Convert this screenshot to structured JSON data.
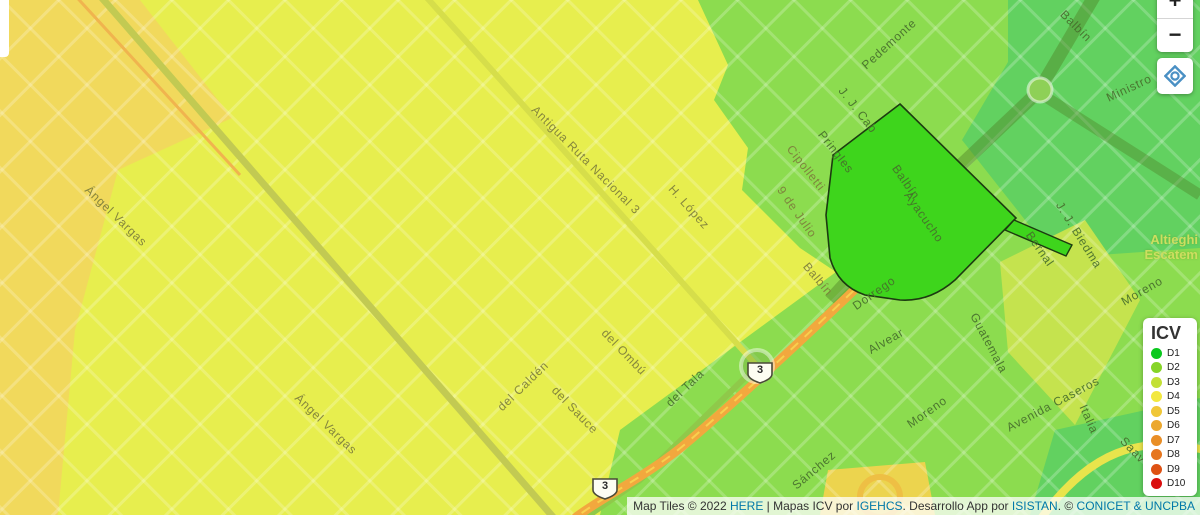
{
  "map": {
    "street_labels": [
      {
        "text": "Ángel Vargas",
        "x": 116,
        "y": 216,
        "rot": 44,
        "zone": "y"
      },
      {
        "text": "Ángel Vargas",
        "x": 326,
        "y": 424,
        "rot": 44,
        "zone": "y"
      },
      {
        "text": "Antigua Ruta Nacional 3",
        "x": 586,
        "y": 160,
        "rot": 45,
        "zone": "y"
      },
      {
        "text": "H. López",
        "x": 689,
        "y": 207,
        "rot": 48,
        "zone": "y"
      },
      {
        "text": "9  de  Julio",
        "x": 797,
        "y": 212,
        "rot": 55,
        "zone": "y"
      },
      {
        "text": "del Caldén",
        "x": 523,
        "y": 386,
        "rot": -44,
        "zone": "y"
      },
      {
        "text": "del Ombú",
        "x": 624,
        "y": 352,
        "rot": 46,
        "zone": "y"
      },
      {
        "text": "del Sauce",
        "x": 575,
        "y": 410,
        "rot": 46,
        "zone": "y"
      },
      {
        "text": "del Tala",
        "x": 685,
        "y": 388,
        "rot": -44,
        "zone": "g"
      },
      {
        "text": "Pedemonte",
        "x": 889,
        "y": 44,
        "rot": -42,
        "zone": "g"
      },
      {
        "text": "J. J. Cab",
        "x": 858,
        "y": 110,
        "rot": 52,
        "zone": "g"
      },
      {
        "text": "Pringles",
        "x": 836,
        "y": 152,
        "rot": 52,
        "zone": "g"
      },
      {
        "text": "Cipolletti",
        "x": 806,
        "y": 168,
        "rot": 52,
        "zone": "y"
      },
      {
        "text": "Balbín",
        "x": 818,
        "y": 279,
        "rot": 50,
        "zone": "y"
      },
      {
        "text": "Balbín",
        "x": 906,
        "y": 182,
        "rot": 55,
        "zone": "g"
      },
      {
        "text": "Ayacucho",
        "x": 924,
        "y": 217,
        "rot": 55,
        "zone": "g"
      },
      {
        "text": "Dorrego",
        "x": 874,
        "y": 293,
        "rot": -35,
        "zone": "g"
      },
      {
        "text": "Alvear",
        "x": 886,
        "y": 341,
        "rot": -30,
        "zone": "g"
      },
      {
        "text": "Moreno",
        "x": 927,
        "y": 412,
        "rot": -35,
        "zone": "g"
      },
      {
        "text": "Guatemala",
        "x": 989,
        "y": 343,
        "rot": 62,
        "zone": "g"
      },
      {
        "text": "Avenida  Caseros",
        "x": 1053,
        "y": 404,
        "rot": -28,
        "zone": "g"
      },
      {
        "text": "Italia",
        "x": 1089,
        "y": 419,
        "rot": 66,
        "zone": "g"
      },
      {
        "text": "Moreno",
        "x": 1142,
        "y": 291,
        "rot": -30,
        "zone": "g"
      },
      {
        "text": "Saav",
        "x": 1133,
        "y": 450,
        "rot": 46,
        "zone": "g"
      },
      {
        "text": "Sánchez",
        "x": 814,
        "y": 470,
        "rot": -40,
        "zone": "g"
      },
      {
        "text": "Bernal",
        "x": 1040,
        "y": 249,
        "rot": 55,
        "zone": "g"
      },
      {
        "text": "J. J. Biedma",
        "x": 1079,
        "y": 235,
        "rot": 58,
        "zone": "g"
      },
      {
        "text": "Balbín",
        "x": 1076,
        "y": 26,
        "rot": 45,
        "zone": "g"
      },
      {
        "text": "Ministro",
        "x": 1129,
        "y": 88,
        "rot": -25,
        "zone": "g"
      }
    ],
    "locality_label": {
      "line1": "Altieghi",
      "line2": "Escatem"
    },
    "route_shields": [
      {
        "number": "3",
        "x": 759,
        "y": 372
      },
      {
        "number": "3",
        "x": 604,
        "y": 485
      }
    ]
  },
  "legend": {
    "title": "ICV",
    "items": [
      {
        "label": "D1",
        "color": "#0ac81e"
      },
      {
        "label": "D2",
        "color": "#86d428"
      },
      {
        "label": "D3",
        "color": "#c3e036"
      },
      {
        "label": "D4",
        "color": "#f2e840"
      },
      {
        "label": "D5",
        "color": "#f0c738"
      },
      {
        "label": "D6",
        "color": "#eca82e"
      },
      {
        "label": "D7",
        "color": "#e98e26"
      },
      {
        "label": "D8",
        "color": "#e6761e"
      },
      {
        "label": "D9",
        "color": "#de5214"
      },
      {
        "label": "D10",
        "color": "#da0f0f"
      }
    ]
  },
  "controls": {
    "zoom_in": "+",
    "zoom_out": "−",
    "locate_color": "#4a90c4"
  },
  "attribution": {
    "segments": [
      {
        "text": "Map Tiles © 2022 ",
        "link": false
      },
      {
        "text": "HERE",
        "link": true
      },
      {
        "text": " | Mapas ICV por ",
        "link": false
      },
      {
        "text": "IGEHCS",
        "link": true
      },
      {
        "text": ". Desarrollo App por ",
        "link": false
      },
      {
        "text": "ISISTAN",
        "link": true
      },
      {
        "text": ". © ",
        "link": false
      },
      {
        "text": "CONICET & UNCPBA",
        "link": true
      }
    ]
  },
  "colors": {
    "zone_yellow": "#e7ee4e",
    "zone_amber": "#f1d95c",
    "zone_green": "#8cdc4f",
    "zone_teal_green": "#62d160",
    "zone_light_green": "#c5e34e",
    "selected_polygon": "#3ed51c",
    "orange_road": "#f2a83e",
    "link_blue": "#0078A8"
  }
}
